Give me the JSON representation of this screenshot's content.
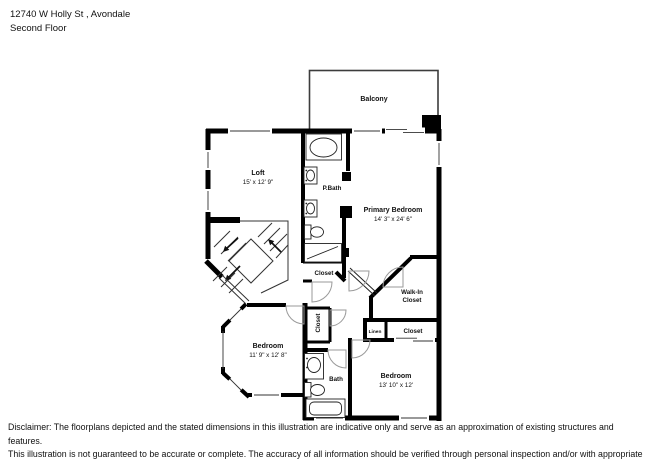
{
  "header": {
    "address": "12740 W Holly St , Avondale",
    "floor": "Second Floor"
  },
  "plan": {
    "balcony": {
      "label": "Balcony"
    },
    "loft": {
      "label": "Loft",
      "dims": "15' x 12' 9\""
    },
    "primary_bath": {
      "label": "P.Bath"
    },
    "primary_bedroom": {
      "label": "Primary Bedroom",
      "dims": "14' 3\" x 24' 6\""
    },
    "hall_closet": {
      "label": "Closet"
    },
    "walk_in_closet": {
      "label_line1": "Walk-In",
      "label_line2": "Closet"
    },
    "bedroom_left": {
      "label": "Bedroom",
      "dims": "11' 9\" x 12' 8\""
    },
    "bedroom_closet": {
      "label": "Closet"
    },
    "bath": {
      "label": "Bath"
    },
    "bedroom_right": {
      "label": "Bedroom",
      "dims": "13' 10\" x 12'"
    },
    "linen": {
      "label": "Linen"
    },
    "right_closet": {
      "label": "Closet"
    }
  },
  "disclaimer": {
    "line1": "Disclaimer: The floorplans depicted and the stated dimensions in this illustration are indicative only and serve as an approximation of existing structures and features.",
    "line2": "This illustration is not guaranteed to be accurate or complete. The accuracy of all information should be verified through personal inspection and/or with appropriate professionals."
  },
  "colors": {
    "wall": "#000000",
    "balcony_wall": "#3c3c3c",
    "door_arc": "#9a9a9a",
    "text": "#111111",
    "background": "#ffffff"
  }
}
